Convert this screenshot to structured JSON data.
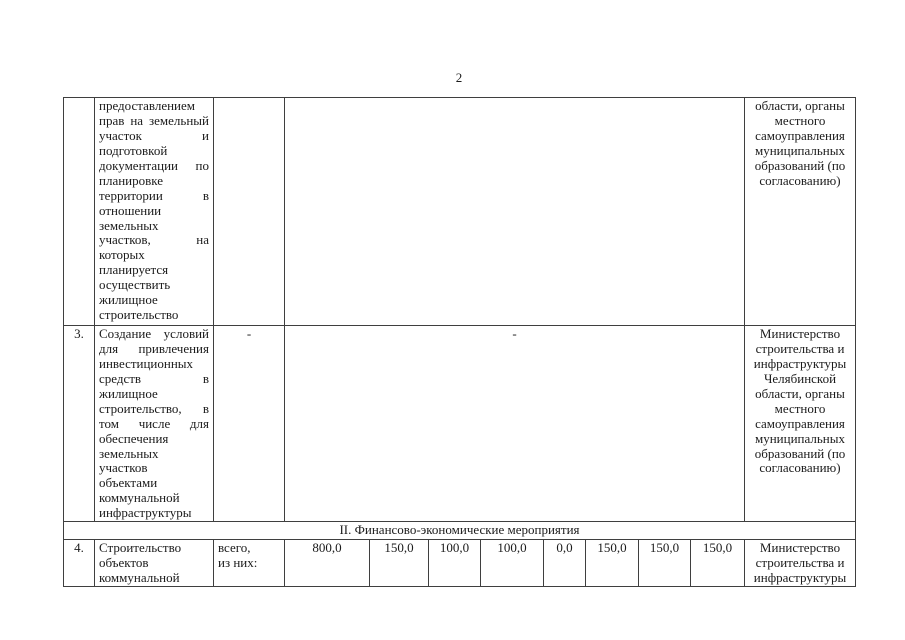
{
  "page": {
    "number": "2"
  },
  "table": {
    "row_continuation": {
      "num": "",
      "description": "предоставлением прав на земельный участок и подготовкой документации по планировке территории в отношении земельных участков, на которых планируется осуществить жилищное строительство",
      "total_col": "",
      "values_merged": "",
      "responsible": "области, органы местного самоуправления муниципальных образований (по согласованию)"
    },
    "row_3": {
      "num": "3.",
      "description": "Создание условий для привлечения инвестиционных средств в жилищное строительство, в том числе для обеспечения земельных участков объектами коммунальной инфраструктуры",
      "total_col": "-",
      "values_merged": "-",
      "responsible": "Министерство строительства и инфраструктуры Челябинской области, органы местного самоуправления муниципальных образований (по согласованию)"
    },
    "section_header": "II. Финансово-экономические мероприятия",
    "row_4": {
      "num": "4.",
      "description": "Строительство объектов коммунальной",
      "total_line1": "всего,",
      "total_line2": "из них:",
      "values": [
        "800,0",
        "150,0",
        "100,0",
        "100,0",
        "0,0",
        "150,0",
        "150,0",
        "150,0"
      ],
      "responsible": "Министерство строительства и инфраструктуры"
    }
  }
}
